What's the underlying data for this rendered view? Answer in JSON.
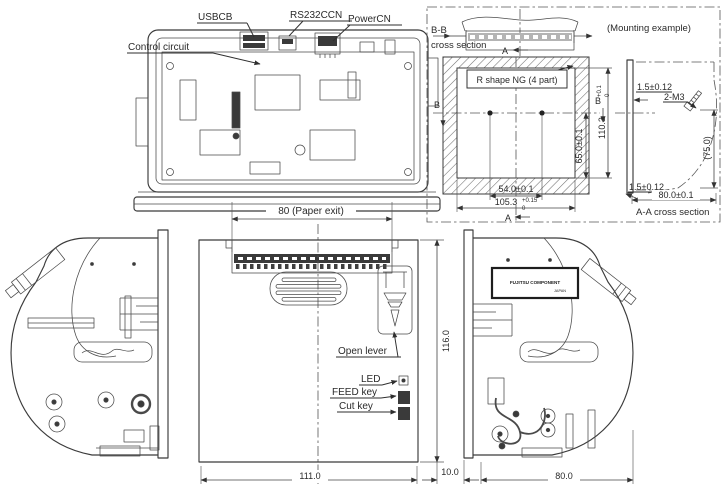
{
  "colors": {
    "line": "#3b3b3b",
    "text": "#2a2a2a",
    "hatch": "#6f6f6f",
    "panel_gray": "#b4b4b4",
    "dark_fill": "#3a3a3a"
  },
  "top_view": {
    "labels": {
      "usb": "USBCB",
      "rs232": "RS232CCN",
      "power": "PowerCN",
      "control": "Control circuit"
    }
  },
  "mounting": {
    "section_bb": {
      "line1": "B-B",
      "line2": "cross section"
    },
    "example_caption": "(Mounting example)",
    "marker_a": "A",
    "marker_b": "B",
    "cutout_note": "R shape NG (4 part)",
    "dims": {
      "height": {
        "value": "110.3",
        "tol_plus": "+0.1",
        "tol_minus": "0"
      },
      "hole_to_bottom": "65.0±0.1",
      "hole_pitch": "54.0±0.1",
      "width": {
        "value": "105.3",
        "tol_plus": "+0.15",
        "tol_minus": "0"
      }
    },
    "section_aa": {
      "caption": "A-A cross section",
      "panel_thickness": "1.5±0.12",
      "screws": "2-M3",
      "depth_ref": "(75.0)",
      "clearance": "1.5±0.12",
      "depth": "80.0±0.1"
    }
  },
  "front_view": {
    "paper_exit": "80 (Paper exit)",
    "open_lever": "Open lever",
    "led": "LED",
    "feed_key": "FEED key",
    "cut_key": "Cut key",
    "height": "116.0",
    "width": "111.0"
  },
  "side_right": {
    "gap": "10.0",
    "depth": "80.0",
    "nameplate": {
      "line1": "FUJITSU COMPONENT",
      "line2": "JAPAN"
    }
  }
}
